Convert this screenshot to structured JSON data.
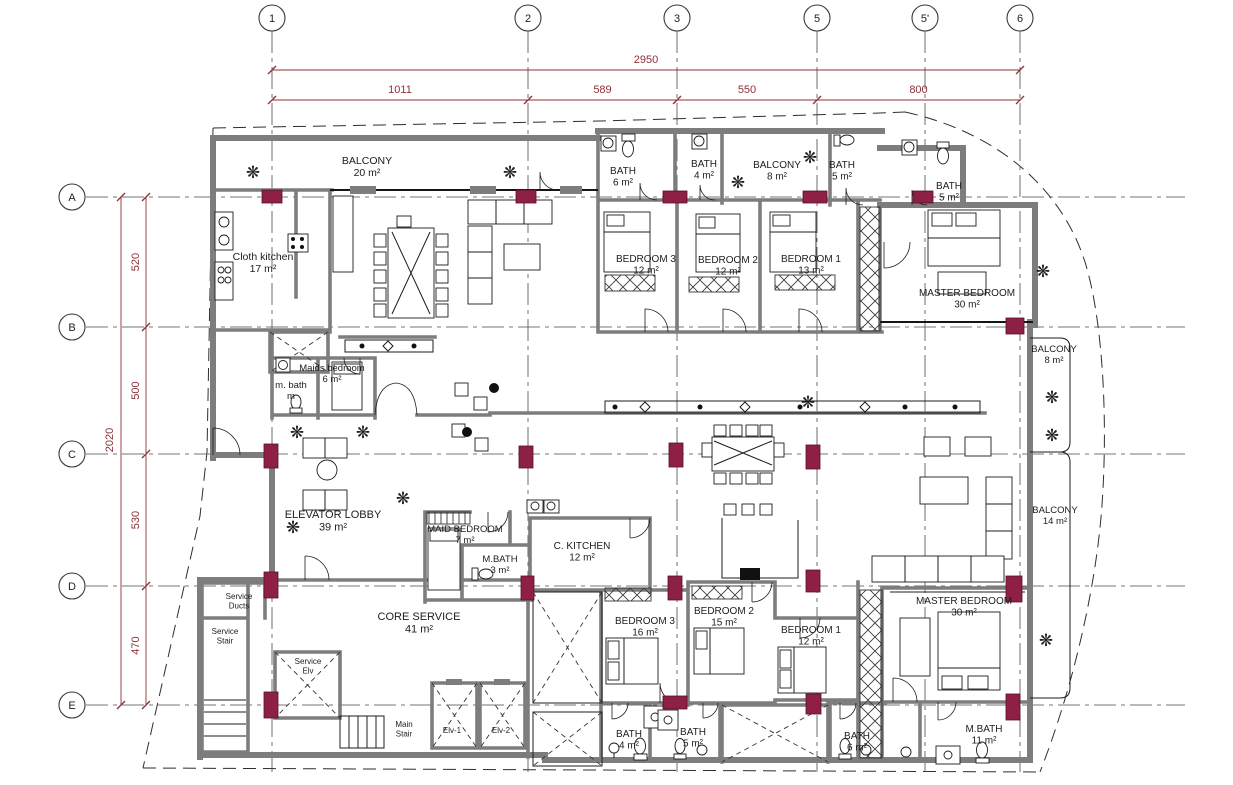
{
  "colors": {
    "wall": "#7d7d7d",
    "column": "#8d2044",
    "dimension": "#8e3038",
    "line": "#1c1c1c",
    "background": "#ffffff"
  },
  "grid": {
    "top_bubbles": [
      {
        "label": "1",
        "x": 272
      },
      {
        "label": "2",
        "x": 528
      },
      {
        "label": "3",
        "x": 677
      },
      {
        "label": "5",
        "x": 817
      },
      {
        "label": "5'",
        "x": 925
      },
      {
        "label": "6",
        "x": 1020
      }
    ],
    "left_bubbles": [
      {
        "label": "A",
        "y": 197
      },
      {
        "label": "B",
        "y": 327
      },
      {
        "label": "C",
        "y": 454
      },
      {
        "label": "D",
        "y": 586
      },
      {
        "label": "E",
        "y": 705
      }
    ]
  },
  "dimensions": {
    "top": {
      "overall": {
        "label": "2950",
        "x1": 272,
        "x2": 1020,
        "line_y": 70,
        "text_x": 646,
        "text_y": 63
      },
      "segment_line_y": 100,
      "segment_text_y": 93,
      "segments": [
        {
          "label": "1011",
          "x1": 272,
          "x2": 528
        },
        {
          "label": "589",
          "x1": 528,
          "x2": 677
        },
        {
          "label": "550",
          "x1": 677,
          "x2": 817
        },
        {
          "label": "800",
          "x1": 817,
          "x2": 1020
        }
      ]
    },
    "left": {
      "overall": {
        "label": "2020",
        "y1": 197,
        "y2": 705,
        "line_x": 121,
        "text_x": 113,
        "text_y": 440
      },
      "segment_line_x": 146,
      "segment_text_x": 139,
      "segments": [
        {
          "label": "520",
          "y1": 197,
          "y2": 327
        },
        {
          "label": "500",
          "y1": 327,
          "y2": 454
        },
        {
          "label": "530",
          "y1": 454,
          "y2": 586
        },
        {
          "label": "470",
          "y1": 586,
          "y2": 705
        }
      ]
    }
  },
  "rooms": [
    {
      "lines": [
        "BALCONY",
        "20 m²"
      ],
      "x": 367,
      "y": 164,
      "fs": 10.5
    },
    {
      "lines": [
        "Cloth kitchen",
        "17 m²"
      ],
      "x": 263,
      "y": 260,
      "fs": 10.5
    },
    {
      "lines": [
        "BATH",
        "6 m²"
      ],
      "x": 623,
      "y": 174,
      "fs": 10
    },
    {
      "lines": [
        "BATH",
        "4 m²"
      ],
      "x": 704,
      "y": 167,
      "fs": 10
    },
    {
      "lines": [
        "BALCONY",
        "8 m²"
      ],
      "x": 777,
      "y": 168,
      "fs": 10
    },
    {
      "lines": [
        "BATH",
        "5 m²"
      ],
      "x": 842,
      "y": 168,
      "fs": 10
    },
    {
      "lines": [
        "BATH",
        "5 m²"
      ],
      "x": 949,
      "y": 189,
      "fs": 10
    },
    {
      "lines": [
        "BEDROOM 3",
        "12 m²"
      ],
      "x": 646,
      "y": 262,
      "fs": 10
    },
    {
      "lines": [
        "BEDROOM 2",
        "12 m²"
      ],
      "x": 728,
      "y": 263,
      "fs": 10
    },
    {
      "lines": [
        "BEDROOM 1",
        "13 m²"
      ],
      "x": 811,
      "y": 262,
      "fs": 10
    },
    {
      "lines": [
        "MASTER BEDROOM",
        "30 m²"
      ],
      "x": 967,
      "y": 296,
      "fs": 10
    },
    {
      "lines": [
        "BALCONY",
        "8 m²"
      ],
      "x": 1054,
      "y": 352,
      "fs": 9.5
    },
    {
      "lines": [
        "Maids bedroom",
        "6 m²"
      ],
      "x": 332,
      "y": 371,
      "fs": 9.5
    },
    {
      "lines": [
        "m. bath",
        "m"
      ],
      "x": 291,
      "y": 388,
      "fs": 9.5
    },
    {
      "lines": [
        "ELEVATOR LOBBY",
        "39 m²"
      ],
      "x": 333,
      "y": 518,
      "fs": 11
    },
    {
      "lines": [
        "MAID BEDROOM",
        "7 m²"
      ],
      "x": 465,
      "y": 532,
      "fs": 9.5
    },
    {
      "lines": [
        "M.BATH",
        "3 m²"
      ],
      "x": 500,
      "y": 562,
      "fs": 9.5
    },
    {
      "lines": [
        "C. KITCHEN",
        "12 m²"
      ],
      "x": 582,
      "y": 549,
      "fs": 10
    },
    {
      "lines": [
        "BALCONY",
        "14 m²"
      ],
      "x": 1055,
      "y": 513,
      "fs": 9.5
    },
    {
      "lines": [
        "CORE SERVICE",
        "41 m²"
      ],
      "x": 419,
      "y": 620,
      "fs": 11
    },
    {
      "lines": [
        "Service",
        "Ducts"
      ],
      "x": 239,
      "y": 599,
      "fs": 8
    },
    {
      "lines": [
        "Service",
        "Stair"
      ],
      "x": 225,
      "y": 634,
      "fs": 8
    },
    {
      "lines": [
        "Service",
        "Elv"
      ],
      "x": 308,
      "y": 664,
      "fs": 8
    },
    {
      "lines": [
        "Main",
        "Stair"
      ],
      "x": 404,
      "y": 727,
      "fs": 8
    },
    {
      "lines": [
        "Elv-1"
      ],
      "x": 452,
      "y": 733,
      "fs": 8
    },
    {
      "lines": [
        "Elv-2"
      ],
      "x": 501,
      "y": 733,
      "fs": 8
    },
    {
      "lines": [
        "BEDROOM 3",
        "16 m²"
      ],
      "x": 645,
      "y": 624,
      "fs": 10
    },
    {
      "lines": [
        "BEDROOM 2",
        "15 m²"
      ],
      "x": 724,
      "y": 614,
      "fs": 10
    },
    {
      "lines": [
        "BEDROOM 1",
        "12 m²"
      ],
      "x": 811,
      "y": 633,
      "fs": 10
    },
    {
      "lines": [
        "MASTER BEDROOM",
        "30 m²"
      ],
      "x": 964,
      "y": 604,
      "fs": 10
    },
    {
      "lines": [
        "BATH",
        "4 m²"
      ],
      "x": 629,
      "y": 737,
      "fs": 10
    },
    {
      "lines": [
        "BATH",
        "5 m²"
      ],
      "x": 693,
      "y": 735,
      "fs": 10
    },
    {
      "lines": [
        "BATH",
        "6 m²"
      ],
      "x": 857,
      "y": 739,
      "fs": 10
    },
    {
      "lines": [
        "M.BATH",
        "11 m²"
      ],
      "x": 984,
      "y": 732,
      "fs": 10
    }
  ],
  "plants": [
    {
      "x": 253,
      "y": 178
    },
    {
      "x": 510,
      "y": 178
    },
    {
      "x": 738,
      "y": 188
    },
    {
      "x": 810,
      "y": 163
    },
    {
      "x": 297,
      "y": 438
    },
    {
      "x": 363,
      "y": 438
    },
    {
      "x": 403,
      "y": 504
    },
    {
      "x": 293,
      "y": 533
    },
    {
      "x": 808,
      "y": 408
    },
    {
      "x": 1052,
      "y": 403
    },
    {
      "x": 1052,
      "y": 441
    },
    {
      "x": 1043,
      "y": 277
    },
    {
      "x": 1046,
      "y": 646
    }
  ],
  "columns": [
    {
      "x": 262,
      "y": 190,
      "w": 20,
      "h": 13
    },
    {
      "x": 516,
      "y": 190,
      "w": 20,
      "h": 13
    },
    {
      "x": 663,
      "y": 191,
      "w": 24,
      "h": 12
    },
    {
      "x": 803,
      "y": 191,
      "w": 24,
      "h": 12
    },
    {
      "x": 913,
      "y": 191,
      "w": 20,
      "h": 12
    },
    {
      "x": 1006,
      "y": 318,
      "w": 18,
      "h": 16
    },
    {
      "x": 264,
      "y": 444,
      "w": 14,
      "h": 24
    },
    {
      "x": 519,
      "y": 446,
      "w": 14,
      "h": 22
    },
    {
      "x": 669,
      "y": 443,
      "w": 14,
      "h": 24
    },
    {
      "x": 806,
      "y": 445,
      "w": 14,
      "h": 24
    },
    {
      "x": 264,
      "y": 572,
      "w": 14,
      "h": 26
    },
    {
      "x": 521,
      "y": 576,
      "w": 13,
      "h": 24
    },
    {
      "x": 668,
      "y": 576,
      "w": 14,
      "h": 24
    },
    {
      "x": 806,
      "y": 570,
      "w": 14,
      "h": 22
    },
    {
      "x": 1006,
      "y": 576,
      "w": 16,
      "h": 26
    },
    {
      "x": 1006,
      "y": 694,
      "w": 14,
      "h": 26
    },
    {
      "x": 264,
      "y": 692,
      "w": 14,
      "h": 26
    },
    {
      "x": 663,
      "y": 696,
      "w": 24,
      "h": 13
    },
    {
      "x": 806,
      "y": 694,
      "w": 15,
      "h": 20
    }
  ]
}
